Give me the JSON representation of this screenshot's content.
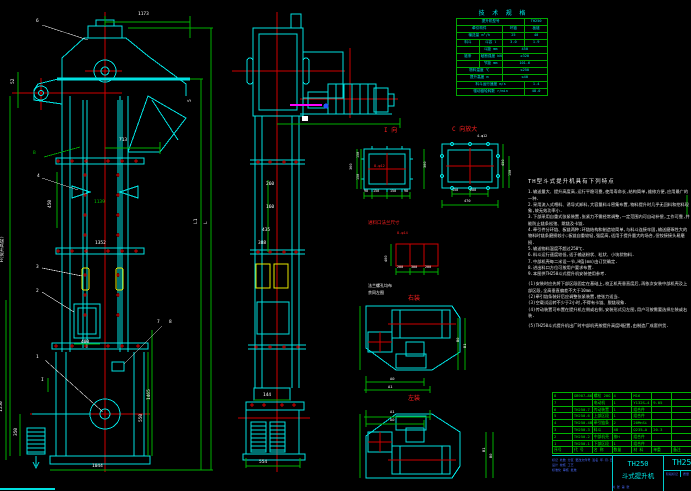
{
  "app": {
    "title": "TH250 斗式提升机 总图"
  },
  "tech_table": {
    "title": "技 术 规 格",
    "rows": [
      [
        {
          "t": "提升机型号",
          "s": 3
        },
        {
          "t": "TH250"
        }
      ],
      [
        {
          "t": "牵引构件",
          "s": 2
        },
        {
          "t": "环链"
        },
        {
          "t": "板链"
        }
      ],
      [
        {
          "t": "输送量 m³/h",
          "s": 2
        },
        {
          "t": "25"
        },
        {
          "t": "40"
        }
      ],
      [
        {
          "t": "料斗"
        },
        {
          "t": "斗容 l"
        },
        {
          "t": "3.0"
        },
        {
          "t": "1.9"
        }
      ],
      [
        {
          "t": ""
        },
        {
          "t": "斗距 mm"
        },
        {
          "t": "450",
          "s": 2
        }
      ],
      [
        {
          "t": "链条"
        },
        {
          "t": "破断强度 kN"
        },
        {
          "t": "≥320",
          "s": 2
        }
      ],
      [
        {
          "t": ""
        },
        {
          "t": "节距 mm"
        },
        {
          "t": "101.6",
          "s": 2
        }
      ],
      [
        {
          "t": "物料温度 ℃",
          "s": 2
        },
        {
          "t": "≤250",
          "s": 2
        }
      ],
      [
        {
          "t": "提升高度 m",
          "s": 2
        },
        {
          "t": "≤40",
          "s": 2
        }
      ],
      [
        {
          "t": "料斗运行速度 m/s",
          "s": 3
        },
        {
          "t": "1.4"
        }
      ],
      [
        {
          "t": "驱动链轮转数 r/min",
          "s": 3
        },
        {
          "t": "48.0"
        }
      ]
    ]
  },
  "notes": {
    "heading": "TH型斗式提升机具有下列特点",
    "lines": [
      "1.输送量大、提升高度高,运行平稳可靠,使用寿命长,结构简单,维修方便,应用最广的一种.",
      "2.采用流入式喂料、诱导式卸料,大容量料斗密集布置,物料提升时几乎无回料和挖料现象,故无效功率小.",
      "3.下部采用自重式张紧装置,张紧力不需经常调整,一定范围内可自动补偿,工作可靠,并能防止链条松弛、跳链及卡链.",
      "4.牵引件分环链、板链两种:环链结构和制造较简单,与料斗连接牢固,输送磨琢性大的物料时链条磨损较小;板链自重较轻,强度高,适用于提升量大的场合,但铰接接头易磨损.",
      "5.输送物料温度不超过250℃.",
      "6.料斗运行速度较低,适于输送粉状、粒状、小块状物料.",
      "7.中部机壳每二米设一节,H值(mm)由订货确定.",
      "8.进出料口方位可按用户要求布置.",
      "9.本图供TH250斗式提升机安装使用参考.",
      "",
      "(1)安装时应先将下部区段固定在基础上,校正机壳垂直度后,再依次安装中部机壳及上部区段,全高垂直偏差不大于10mm.",
      "(2)牵引链条装好后应调整张紧装置,使张力适当.",
      "(3)空载试运转不少于2小时,不得有卡链、脱链现象.",
      "(4)传动装置可布置在提升机左侧或右侧,安装形式见左图,用户可按需要选择左装或右装.",
      "",
      "(5)TH250斗式提升机出厂时中部机壳按提升高度H配置,由制造厂成套供货."
    ]
  },
  "bom": {
    "rows": [
      [
        "8",
        "GB907—86",
        "螺栓 20G",
        "4",
        "M16",
        "",
        ""
      ],
      [
        "7",
        "",
        "电动机",
        "1",
        "Y132S—4",
        "9.05",
        ""
      ],
      [
        "6",
        "TH250.7",
        "传动装置",
        "1",
        "组合件",
        "",
        ""
      ],
      [
        "5",
        "TH250.6",
        "上部区段",
        "1",
        "组合件",
        "",
        ""
      ],
      [
        "4",
        "TH250.4B",
        "牵引链条",
        "2",
        "20MnSi",
        "",
        ""
      ],
      [
        "3",
        "TH250.3",
        "料斗",
        "48",
        "Q235—A",
        "20.3",
        ""
      ],
      [
        "2",
        "TH250.2",
        "中部机壳",
        "按H",
        "组合件",
        "",
        ""
      ],
      [
        "1",
        "TH250.1",
        "下部区段",
        "1",
        "组合件",
        "",
        ""
      ],
      [
        "序号",
        "代 号",
        "名 称",
        "数量",
        "材 料",
        "单重",
        "备注"
      ]
    ]
  },
  "title_block": {
    "model": "TH250",
    "name": "斗式提升机",
    "drawing_no": "TH250",
    "rev_line": "标记 处数 分区 更改文件号 签名 年.月.日",
    "sign_line1": "设计        校核        工艺",
    "sign_line2": "标准化      审核        批准",
    "stage_label": "阶段标记",
    "mass_label": "质量",
    "scale_label": "比例",
    "scale": "1:25",
    "sheet_line": "共 张 第 张"
  },
  "drawing": {
    "colors": {
      "line": "#00e0e0",
      "dim": "#00c000",
      "center": "#ff0000",
      "text": "#ffffff",
      "bucket": "#e8e800",
      "accent": "#ff00ff",
      "tiny_blue": "#4b6bff"
    },
    "view_titles": {
      "detail_i": "I 向",
      "detail_c": "C 向放大",
      "flange": "进料口法兰尺寸",
      "plan_right": "右装",
      "plan_left": "左装"
    },
    "labels": [
      {
        "t": "6",
        "x": 36,
        "y": 20
      },
      {
        "t": "1173",
        "x": 138,
        "y": 13
      },
      {
        "t": "5",
        "x": 189,
        "y": 102,
        "r": 1
      },
      {
        "t": "52",
        "x": 12,
        "y": 84,
        "r": 1
      },
      {
        "t": "B",
        "x": 33,
        "y": 152,
        "c": "#00c000"
      },
      {
        "t": "713",
        "x": 119,
        "y": 139
      },
      {
        "t": "4",
        "x": 37,
        "y": 175
      },
      {
        "t": "450",
        "x": 49,
        "y": 208,
        "r": 1
      },
      {
        "t": "1139",
        "x": 94,
        "y": 201,
        "c": "#00c000"
      },
      {
        "t": "1352",
        "x": 95,
        "y": 242
      },
      {
        "t": "3",
        "x": 36,
        "y": 266
      },
      {
        "t": "2",
        "x": 36,
        "y": 290
      },
      {
        "t": "H(提升高度)",
        "x": 1,
        "y": 262,
        "r": 1
      },
      {
        "t": "L1",
        "x": 195,
        "y": 224,
        "r": 1
      },
      {
        "t": "L",
        "x": 205,
        "y": 224,
        "r": 1
      },
      {
        "t": "400",
        "x": 81,
        "y": 341
      },
      {
        "t": "7",
        "x": 157,
        "y": 321
      },
      {
        "t": "8",
        "x": 169,
        "y": 321
      },
      {
        "t": "1",
        "x": 36,
        "y": 356
      },
      {
        "t": "I",
        "x": 41,
        "y": 379
      },
      {
        "t": "1550",
        "x": 0,
        "y": 412,
        "r": 1
      },
      {
        "t": "350",
        "x": 15,
        "y": 436,
        "r": 1
      },
      {
        "t": "1465",
        "x": 148,
        "y": 400,
        "r": 1
      },
      {
        "t": "550",
        "x": 140,
        "y": 422,
        "r": 1
      },
      {
        "t": "1044",
        "x": 92,
        "y": 465
      },
      {
        "t": "260",
        "x": 266,
        "y": 183
      },
      {
        "t": "160",
        "x": 266,
        "y": 206
      },
      {
        "t": "435",
        "x": 262,
        "y": 229
      },
      {
        "t": "388",
        "x": 258,
        "y": 242
      },
      {
        "t": "144",
        "x": 263,
        "y": 394
      },
      {
        "t": "554",
        "x": 259,
        "y": 461
      },
      {
        "t": "I 向",
        "x": 384,
        "y": 128,
        "c": "#ff2020",
        "fs": 6
      },
      {
        "t": "8-φ12",
        "x": 374,
        "y": 165,
        "c": "#ff2020",
        "fs": 3.6
      },
      {
        "t": "360",
        "x": 350,
        "y": 170,
        "r": 1,
        "fs": 3.6
      },
      {
        "t": "150",
        "x": 357,
        "y": 158,
        "r": 1,
        "fs": 3.4
      },
      {
        "t": "150",
        "x": 357,
        "y": 180,
        "r": 1,
        "fs": 3.4
      },
      {
        "t": "300",
        "x": 424,
        "y": 168,
        "r": 1,
        "fs": 3.6
      },
      {
        "t": "90",
        "x": 364,
        "y": 190,
        "fs": 3.4
      },
      {
        "t": "150",
        "x": 373,
        "y": 190,
        "fs": 3.4
      },
      {
        "t": "150",
        "x": 390,
        "y": 190,
        "fs": 3.4
      },
      {
        "t": "90",
        "x": 404,
        "y": 190,
        "fs": 3.4
      },
      {
        "t": "C 向放大",
        "x": 452,
        "y": 127,
        "c": "#ff2020",
        "fs": 6
      },
      {
        "t": "4-φ12",
        "x": 477,
        "y": 135,
        "fs": 3.4
      },
      {
        "t": "450",
        "x": 502,
        "y": 166,
        "r": 1,
        "fs": 3.6
      },
      {
        "t": "150",
        "x": 509,
        "y": 176,
        "r": 1,
        "fs": 3.4
      },
      {
        "t": "150",
        "x": 452,
        "y": 189,
        "fs": 3.4
      },
      {
        "t": "200",
        "x": 470,
        "y": 189,
        "fs": 3.4
      },
      {
        "t": "470",
        "x": 464,
        "y": 200,
        "fs": 3.6
      },
      {
        "t": "进料口法兰尺寸",
        "x": 368,
        "y": 222,
        "c": "#ff2020",
        "fs": 4.5
      },
      {
        "t": "8-φ14",
        "x": 397,
        "y": 232,
        "c": "#ff2020",
        "fs": 3.6
      },
      {
        "t": "400",
        "x": 385,
        "y": 262,
        "r": 1,
        "fs": 3.6
      },
      {
        "t": "200",
        "x": 397,
        "y": 266,
        "fs": 3.4
      },
      {
        "t": "300",
        "x": 411,
        "y": 266,
        "fs": 3.4
      },
      {
        "t": "200",
        "x": 425,
        "y": 266,
        "fs": 3.4
      },
      {
        "t": "法兰螺孔均布",
        "x": 368,
        "y": 284,
        "fs": 4
      },
      {
        "t": "余同左图",
        "x": 368,
        "y": 291,
        "fs": 4
      },
      {
        "t": "右装",
        "x": 408,
        "y": 296,
        "c": "#ff2020",
        "fs": 6
      },
      {
        "t": "A0",
        "x": 390,
        "y": 377,
        "fs": 3.8
      },
      {
        "t": "A1",
        "x": 388,
        "y": 385,
        "fs": 3.8
      },
      {
        "t": "B0",
        "x": 456,
        "y": 342,
        "r": 1,
        "fs": 3.8
      },
      {
        "t": "B1",
        "x": 463,
        "y": 348,
        "r": 1,
        "fs": 3.8
      },
      {
        "t": "左装",
        "x": 408,
        "y": 396,
        "c": "#ff2020",
        "fs": 6
      },
      {
        "t": "A1",
        "x": 390,
        "y": 410,
        "fs": 3.8
      },
      {
        "t": "A0",
        "x": 390,
        "y": 418,
        "fs": 3.8
      },
      {
        "t": "B1",
        "x": 482,
        "y": 452,
        "r": 1,
        "fs": 3.8
      },
      {
        "t": "B0",
        "x": 489,
        "y": 458,
        "r": 1,
        "fs": 3.8
      }
    ]
  }
}
